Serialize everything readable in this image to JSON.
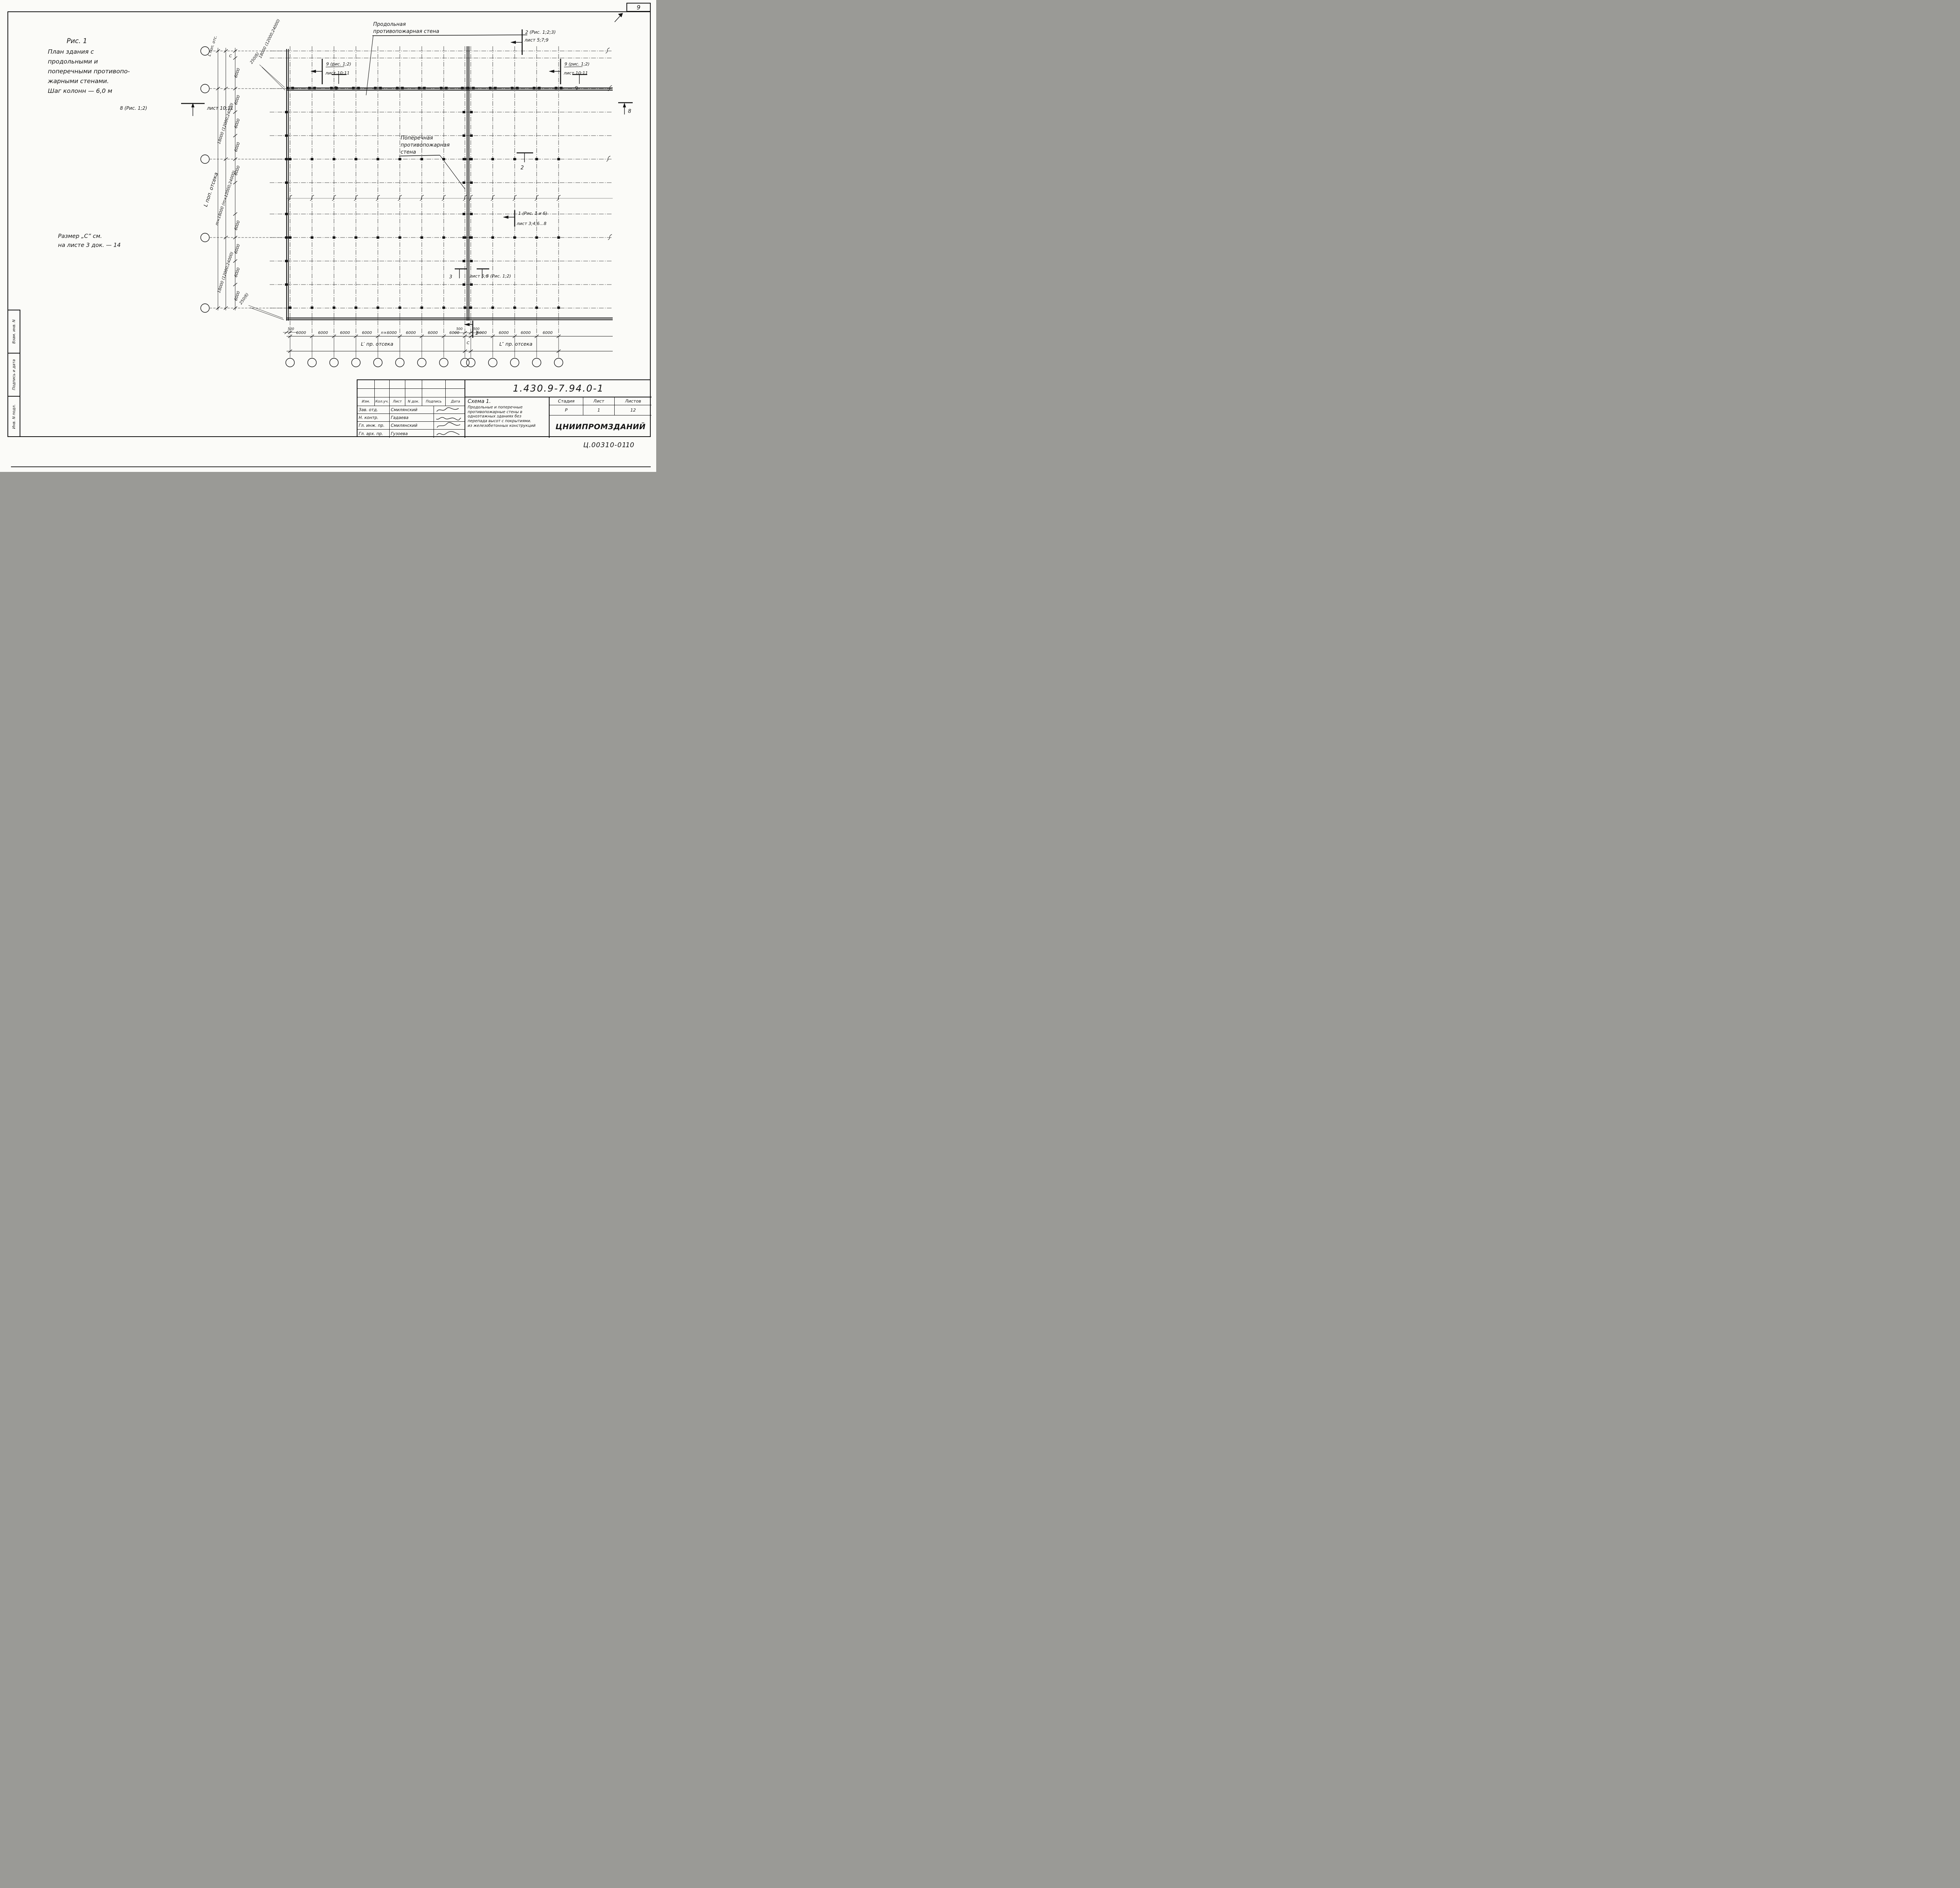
{
  "page": {
    "sheet_number_box": "9",
    "footer_code": "Ц.00310-01",
    "footer_page": "10"
  },
  "sidebar": {
    "cells": [
      "Взам. инв. N",
      "Подпись и дата",
      "Инв. N подл."
    ]
  },
  "notes": {
    "figure_title": [
      "Рис. 1",
      "План здания с",
      "продольными и",
      "поперечными противопо-",
      "жарными стенами.",
      "Шаг колонн — 6,0 м"
    ],
    "size_note": [
      "Размер „С” см.",
      "на листе 3 док. — 14"
    ]
  },
  "plan": {
    "labels": {
      "longitudinal_wall": [
        "Продольная",
        "противопожарная стена"
      ],
      "transverse_wall": [
        "Поперечная",
        "противопожарная",
        "стена"
      ]
    },
    "markers": {
      "sec2_top": [
        "2 (Рис. 1;2;3)",
        "лист 5;7;9"
      ],
      "sec9_left": [
        "9 (рис. 1;2)",
        "лист 10;11"
      ],
      "sec9_right": [
        "9 (рис. 1;2)",
        "лист 10;11"
      ],
      "sec8_left_num": "8 (Рис. 1;2)",
      "sec8_left_ref": "лист 10;11",
      "sec8_right": "8",
      "sec9_tick": "9",
      "sec2_bottom": "2",
      "sec1_mid": [
        "1 (Рис. 1 и 6)",
        "лист 3;4;6...8"
      ],
      "sec3_left_num": "3",
      "sec3_left_ref": "лист 5;6",
      "sec3_right": "3 (Рис. 1;2)",
      "sec1_bottom": "1"
    },
    "dims_left": {
      "axis_top": "L поп. отс.",
      "axis_overall": "L поп. отсека",
      "span_top": "18000 (12000;24000)",
      "span_a": "18000 (12000;24000)",
      "span_b": "m×18000 (m×12000;24000)",
      "span_c": "18000 (12000;24000)",
      "bay": "6000",
      "gap": "С",
      "edge_offset": "250(б)"
    },
    "dims_bottom": {
      "bay": "6000",
      "bay_repeat": "n×6000",
      "edge_offset": "500",
      "joint_left": "500",
      "joint_right": "500",
      "joint_gap": "С",
      "span_left": "L′ пр. отсека",
      "span_right": "L″ пр. отсека"
    }
  },
  "title_block": {
    "doc_number": "1.430.9-7.94.0-1",
    "scheme_title": [
      "Схема 1.",
      "Продольные и поперечные",
      "противопожарные стены в",
      "одноэтажных зданиях без",
      "перепада высот с покрытиями.",
      "из железобетонных конструкций"
    ],
    "revision_header": [
      "Изм.",
      "Кол.уч.",
      "Лист",
      "N док.",
      "Подпись",
      "Дата"
    ],
    "rows": [
      {
        "role": "Зав. отд.",
        "name": "Смилянский"
      },
      {
        "role": "Н. контр.",
        "name": "Гадаева"
      },
      {
        "role": "Гл. инж. пр.",
        "name": "Смилянский"
      },
      {
        "role": "Гл. арх. пр.",
        "name": "Гузоева"
      }
    ],
    "stage_header": [
      "Стадия",
      "Лист",
      "Листов"
    ],
    "stage_values": [
      "Р",
      "1",
      "12"
    ],
    "organization": "ЦНИИПРОМЗДАНИЙ"
  }
}
